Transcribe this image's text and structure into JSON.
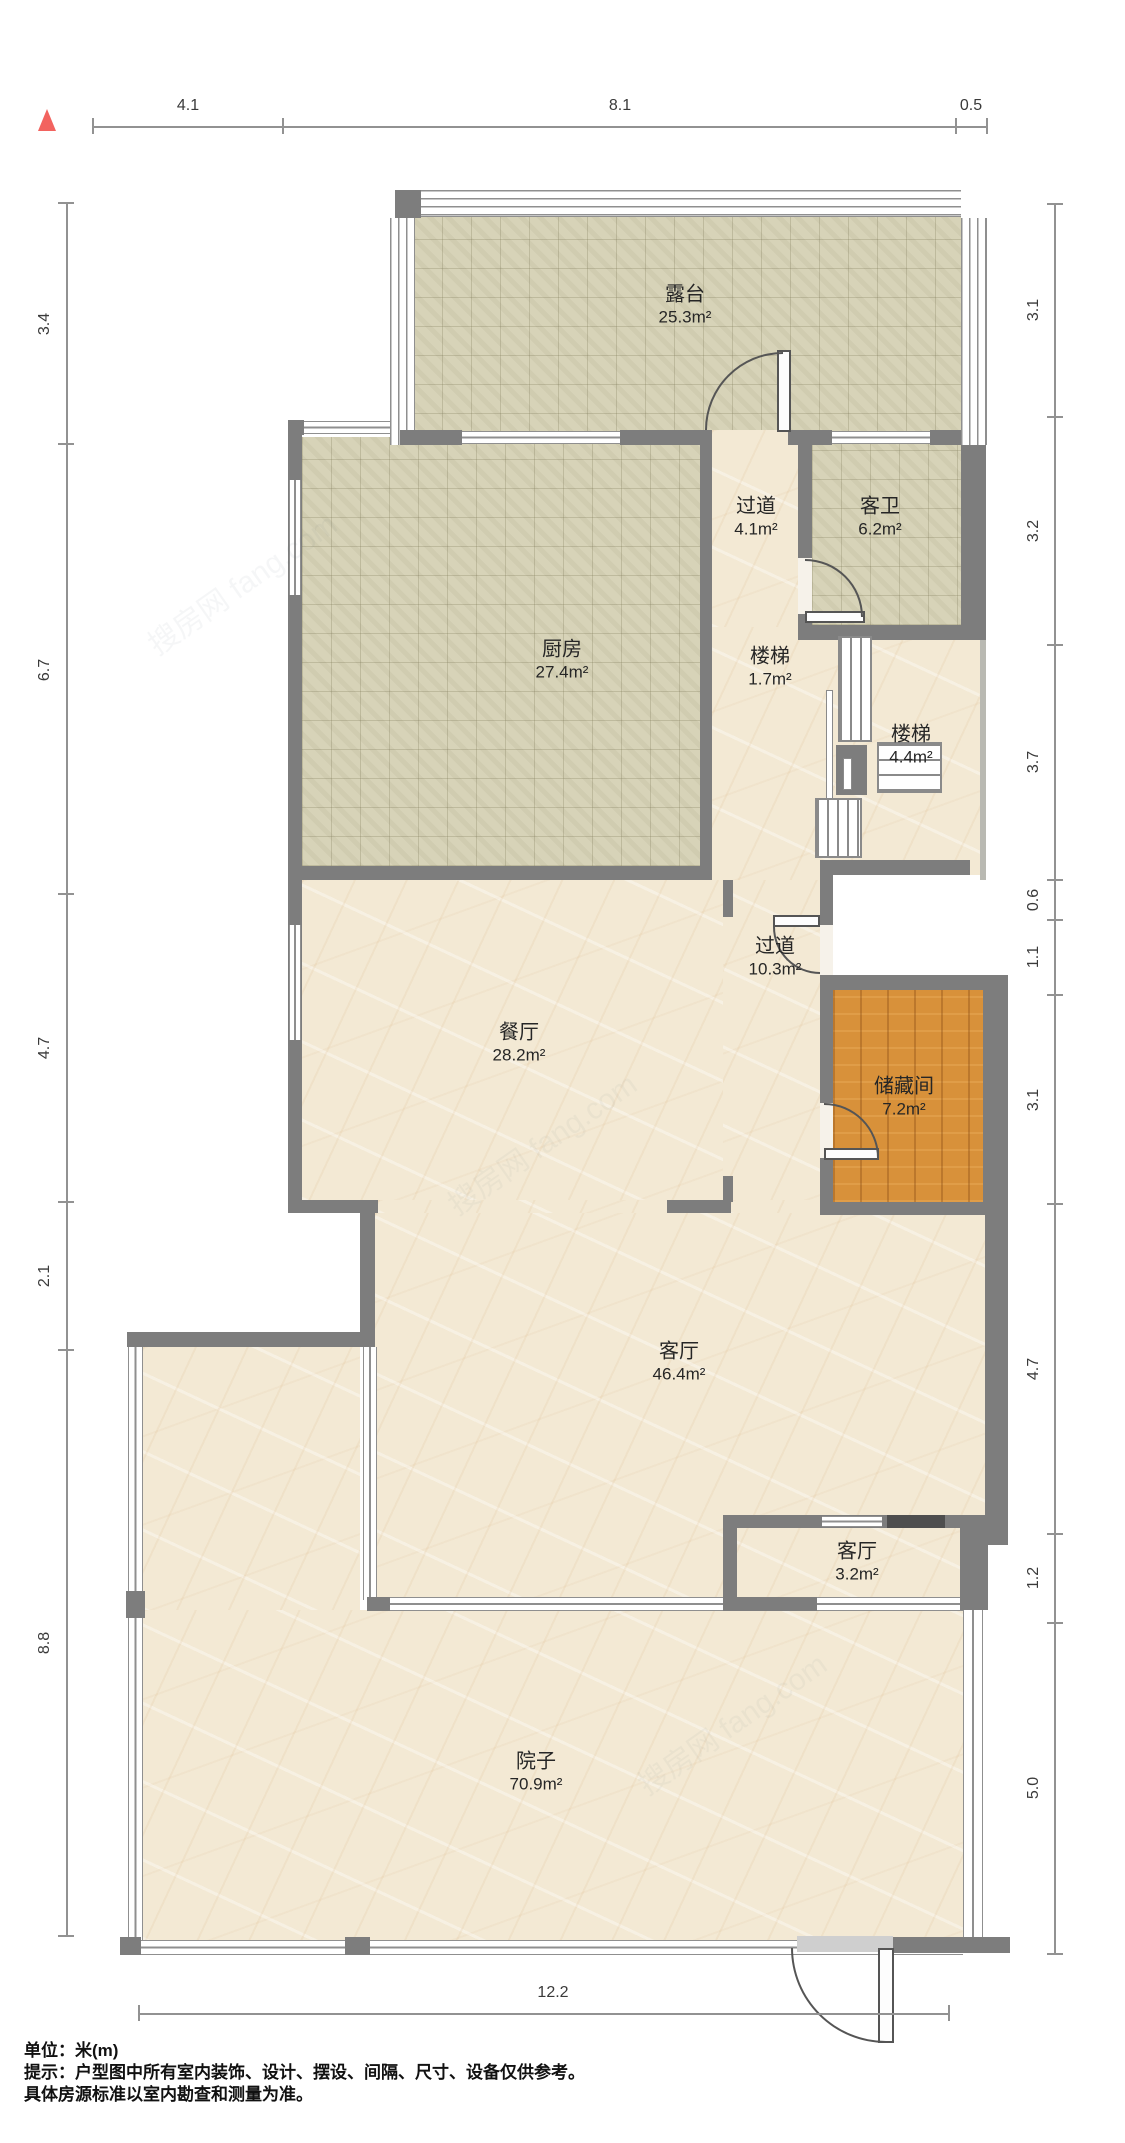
{
  "rooms": {
    "terrace": {
      "name": "露台",
      "area": "25.3m²"
    },
    "hallway_upper": {
      "name": "过道",
      "area": "4.1m²"
    },
    "guest_bath": {
      "name": "客卫",
      "area": "6.2m²"
    },
    "kitchen": {
      "name": "厨房",
      "area": "27.4m²"
    },
    "stairs_small": {
      "name": "楼梯",
      "area": "1.7m²"
    },
    "stairs_large": {
      "name": "楼梯",
      "area": "4.4m²"
    },
    "hallway_lower": {
      "name": "过道",
      "area": "10.3m²"
    },
    "dining": {
      "name": "餐厅",
      "area": "28.2m²"
    },
    "storage": {
      "name": "储藏间",
      "area": "7.2m²"
    },
    "living": {
      "name": "客厅",
      "area": "46.4m²"
    },
    "living_small": {
      "name": "客厅",
      "area": "3.2m²"
    },
    "yard": {
      "name": "院子",
      "area": "70.9m²"
    }
  },
  "dimensions": {
    "top": [
      "4.1",
      "8.1",
      "0.5"
    ],
    "left": [
      "3.4",
      "6.7",
      "4.7",
      "2.1",
      "8.8"
    ],
    "right": [
      "3.1",
      "3.2",
      "3.7",
      "0.6",
      "1.1",
      "3.1",
      "4.7",
      "1.2",
      "5.0"
    ],
    "bottom": [
      "12.2"
    ]
  },
  "footer": {
    "unit_line": "单位：米(m)",
    "tip_line1": "提示：户型图中所有室内装饰、设计、摆设、间隔、尺寸、设备仅供参考。",
    "tip_line2": "具体房源标准以室内勘查和测量为准。"
  },
  "watermark": "搜房网 fang.com",
  "colors": {
    "wall": "#7d7d7d",
    "wall_dark": "#4e4e4e",
    "tile_floor": "#d7d3b8",
    "marble_floor": "#f3e9d4",
    "wood_floor": "#d8913a",
    "north_arrow": "#f2635f",
    "dim": "#929292",
    "door": "#555555"
  }
}
